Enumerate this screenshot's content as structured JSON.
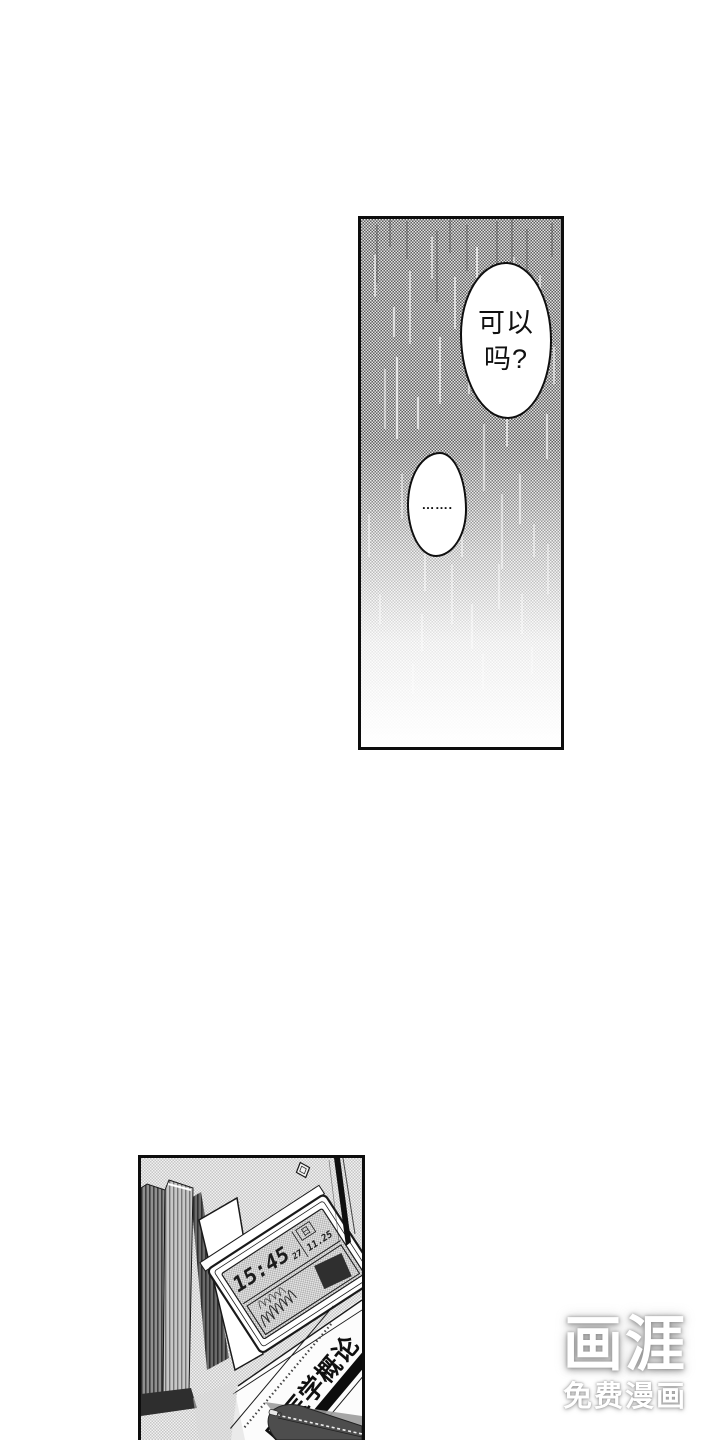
{
  "page": {
    "background": "#ffffff"
  },
  "rain_panel": {
    "speech_bubble_large": {
      "line1": "可以",
      "line2": "吗?"
    },
    "speech_bubble_small": {
      "text": "……."
    }
  },
  "desk_panel": {
    "alarm_clock": {
      "time": "15:45",
      "seconds": "27",
      "weekday": "日",
      "date": "11.25"
    },
    "textbook_title": "床医学概论"
  },
  "watermark": {
    "logo_text": "画涯",
    "tagline": "免费漫画"
  },
  "colors": {
    "ink": "#111111",
    "panel_border": "#0d0d0d",
    "watermark_text": "#ffffff"
  }
}
